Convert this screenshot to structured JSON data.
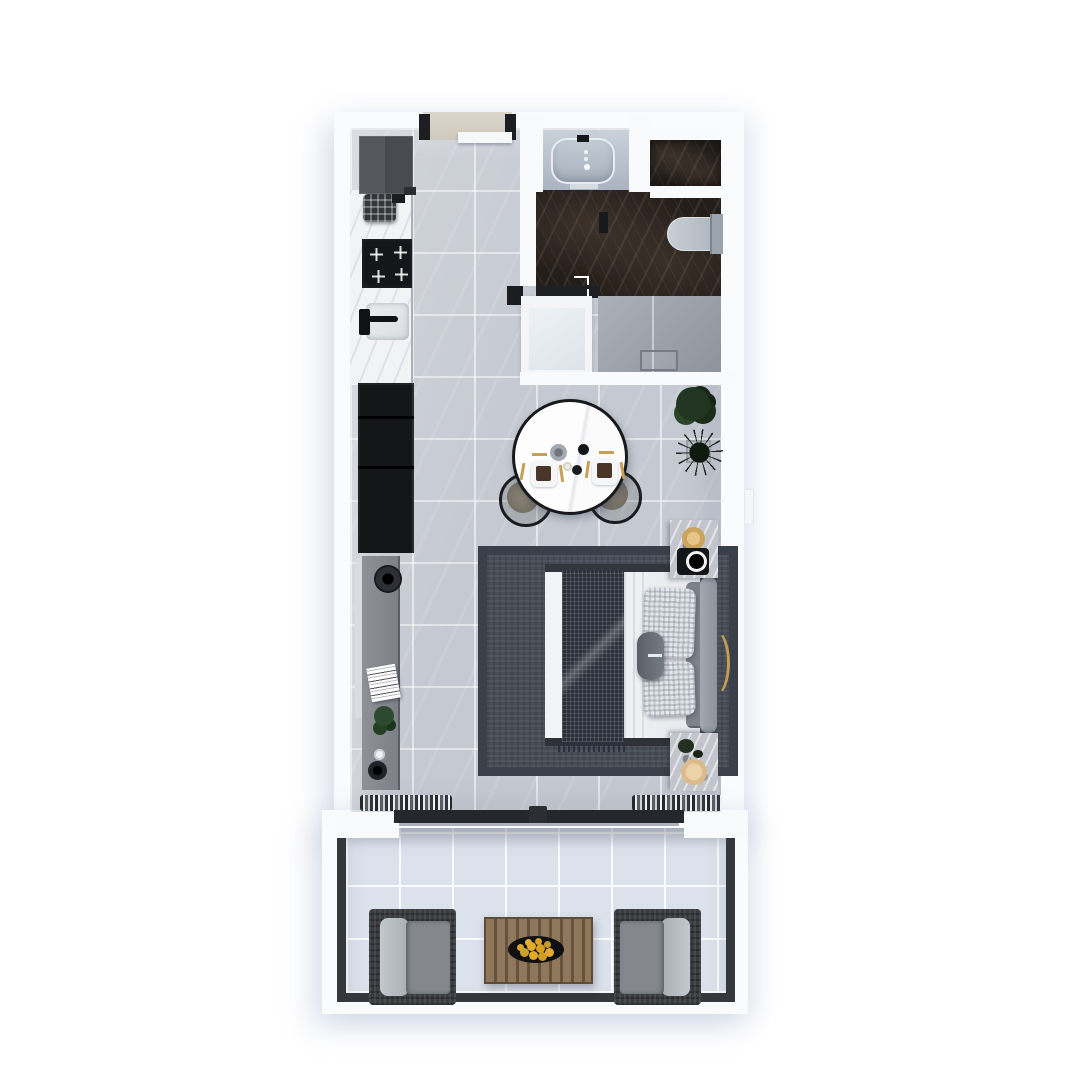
{
  "scene": {
    "title": "Studio apartment floor plan (top-down 3D render)",
    "view": "top-down",
    "has_text": false
  },
  "palette": {
    "page_background": "#ffffff",
    "walls": "#fafbfd",
    "main_floor_tile": "#c5c9d1",
    "balcony_tile": "#dce2eb",
    "bathroom_marble": "#241e1a",
    "dark_furniture": "#17191c",
    "wood": "#8c755a",
    "gold_accent": "#c7a058",
    "rug": "#474d56"
  },
  "rooms": [
    {
      "name": "kitchen",
      "items": [
        "fridge",
        "coffee-machine",
        "cooktop",
        "counter",
        "sink"
      ]
    },
    {
      "name": "entry",
      "items": [
        "entry-door",
        "door-threshold"
      ]
    },
    {
      "name": "bathroom",
      "items": [
        "bathtub",
        "storage-niche",
        "toilet",
        "vanity",
        "walk-in-shower",
        "drain"
      ]
    },
    {
      "name": "living-sleeping",
      "items": [
        "wardrobe",
        "tv",
        "tv-console",
        "speaker",
        "magazines",
        "round-dining-table",
        "dining-chair-left",
        "dining-chair-right",
        "table-setting-x2",
        "bushy-plant",
        "spiky-plant",
        "double-bed",
        "throw-blanket",
        "pillows",
        "bolster-pillow",
        "headboard",
        "area-rug",
        "nightstand-top",
        "nightstand-bottom",
        "table-lamp",
        "floor-lamp",
        "curtains",
        "sliding-glass-door"
      ]
    },
    {
      "name": "balcony",
      "items": [
        "armchair-left",
        "armchair-right",
        "slatted-coffee-table",
        "fruit-tray",
        "railing"
      ]
    }
  ]
}
